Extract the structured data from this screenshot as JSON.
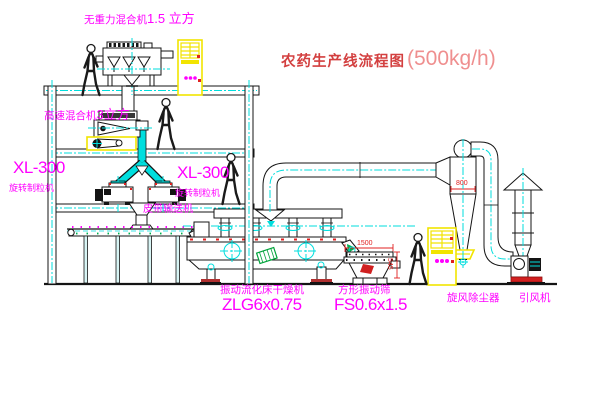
{
  "title": {
    "name": "农药生产线流程图",
    "capacity": "(500kg/h)"
  },
  "equipment_labels": {
    "top_mixer": {
      "name": "无重力混合机",
      "size": "1.5 立方"
    },
    "floor2_mixer": {
      "name": "高速混合机",
      "size": "3立方"
    },
    "granulator_left": {
      "model": "XL-300",
      "name": "旋转制粒机"
    },
    "granulator_right": {
      "model": "XL-300",
      "name": "旋转制粒机"
    },
    "belt_conveyor": "皮带输送机",
    "dryer": {
      "name": "振动流化床干燥机",
      "model": "ZLG6x0.75"
    },
    "sieve": {
      "name": "方形振动筛",
      "model": "FS0.6x1.5"
    },
    "cyclone": "旋风除尘器",
    "fan": "引风机"
  },
  "dimensions": {
    "cyclone_inlet": "800",
    "sieve_length": "1500",
    "sieve_height": "545"
  },
  "colors": {
    "label_magenta": "#ff00ff",
    "title_red": "#d34040",
    "capacity_red": "#ef8f8f",
    "centerline_cyan": "#00dede",
    "cabinet_yellow": "#f2e400",
    "dimension_red": "#e02020",
    "accent_green": "#00b050"
  }
}
